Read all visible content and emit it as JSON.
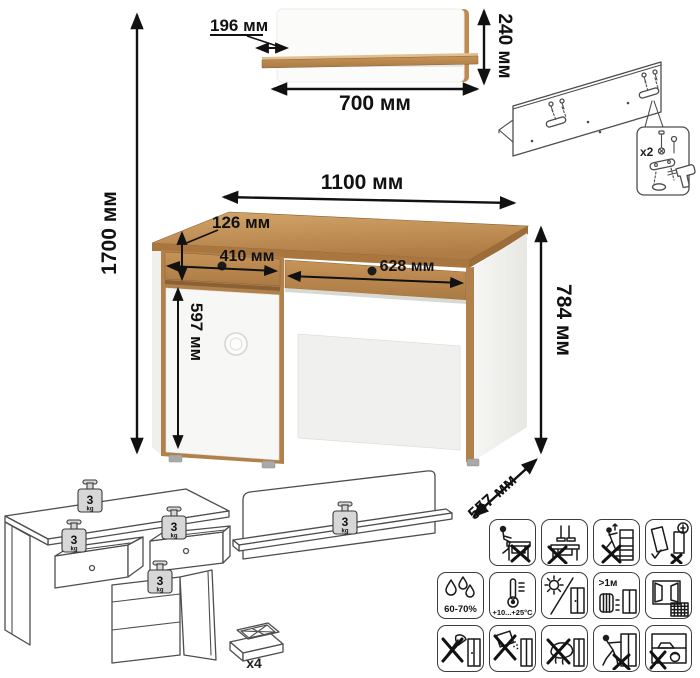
{
  "dimensions": {
    "total_height": "1700 мм",
    "shelf": {
      "depth": "196 мм",
      "height": "240 мм",
      "width": "700 мм"
    },
    "desk": {
      "width": "1100 мм",
      "drawer_height": "126 мм",
      "left_drawer_width": "410 мм",
      "right_drawer_width": "628 мм",
      "door_height": "597 мм",
      "height": "784 мм",
      "depth": "557 мм"
    }
  },
  "assembly": {
    "wall_brackets_count": "x2",
    "feet_count": "x4"
  },
  "load_limits": {
    "desk_top": {
      "value": "3",
      "unit": "kg"
    },
    "left_drawer": {
      "value": "3",
      "unit": "kg"
    },
    "right_drawer": {
      "value": "3",
      "unit": "kg"
    },
    "cabinet_shelf": {
      "value": "3",
      "unit": "kg"
    },
    "wall_shelf": {
      "value": "3",
      "unit": "kg"
    }
  },
  "care_icons": {
    "row1": [
      "no-sitting-on-desk",
      "no-standing-on-desk",
      "no-climbing-on-drawers",
      "assembly-orientation"
    ],
    "row2": [
      "humidity-range",
      "temperature-range",
      "avoid-direct-sunlight",
      "keep-distance-from-heaters",
      "ventilation"
    ],
    "row3": [
      "no-sharp-tools",
      "no-abrasive-cleaners",
      "no-wet-cleaning",
      "no-dragging",
      "no-heavy-hot-objects"
    ],
    "labels": {
      "humidity": "60-70%",
      "temperature": "+10...+25°C",
      "heater_distance": ">1м"
    }
  },
  "colors": {
    "wood": "#b5824b",
    "wood_light": "#d2a66b",
    "wood_dark": "#9a6b39",
    "panel_white": "#f6f6f4",
    "knob": "#1b1b1b",
    "line_art": "#4d4d4d",
    "dimension": "#111111",
    "weight_fill": "#d7d7d7"
  }
}
